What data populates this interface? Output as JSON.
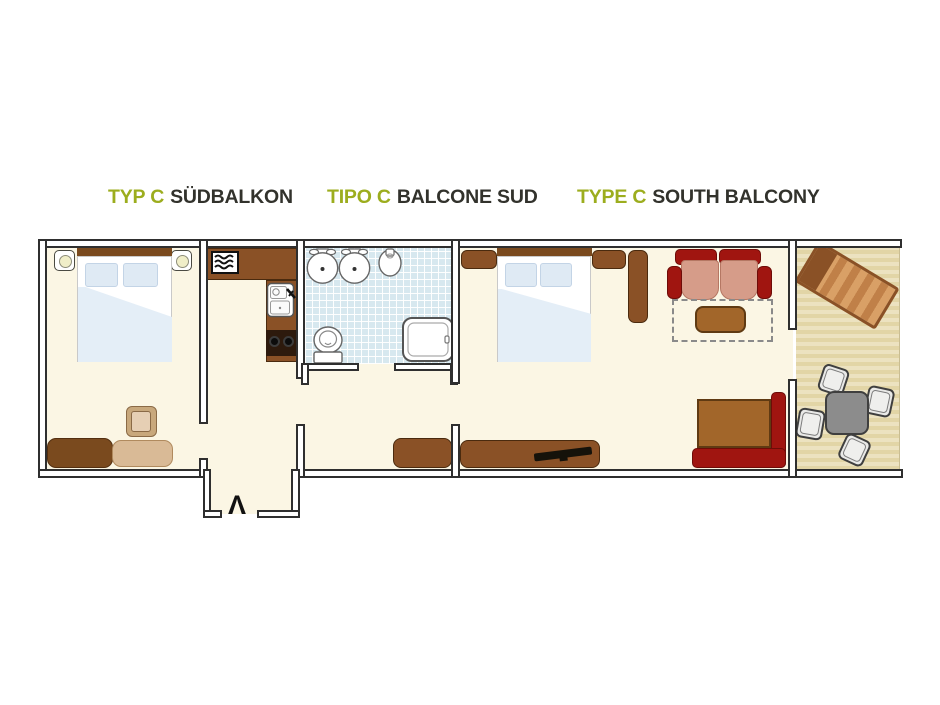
{
  "titles": [
    {
      "type_label": "TYP C",
      "title": "SÜDBALKON"
    },
    {
      "type_label": "TIPO C",
      "title": "BALCONE SUD"
    },
    {
      "type_label": "TYPE C",
      "title": "SOUTH BALCONY"
    }
  ],
  "floor_plan": {
    "entrance_marker": "Λ",
    "icons": {
      "radiator_icon": "three-wavy-lines",
      "stove_icon": "two-burner-circles",
      "lamp_icon": "circle-on-nightstand",
      "tv_icon": "black-diagonal-bar",
      "faucet_icon": "diagonal-tap-lever"
    },
    "colors": {
      "accent_green": "#9CAD1E",
      "heading_text": "#32322C",
      "floor_cream": "#FBF6E4",
      "wall_outline": "#2F2F2F",
      "wood_dark": "#7A4A1E",
      "wood_mid": "#8A5126",
      "wood_light": "#A2662A",
      "tan": "#D9BA96",
      "tan_light": "#E6CFB4",
      "upholstery_red": "#A01510",
      "upholstery_salmon": "#D69C89",
      "bedding_blue": "#DCE9F5",
      "tile_blue": "#D7E8EF",
      "balcony_sand": "#EADFB8",
      "table_gray": "#8C8C8C"
    }
  }
}
